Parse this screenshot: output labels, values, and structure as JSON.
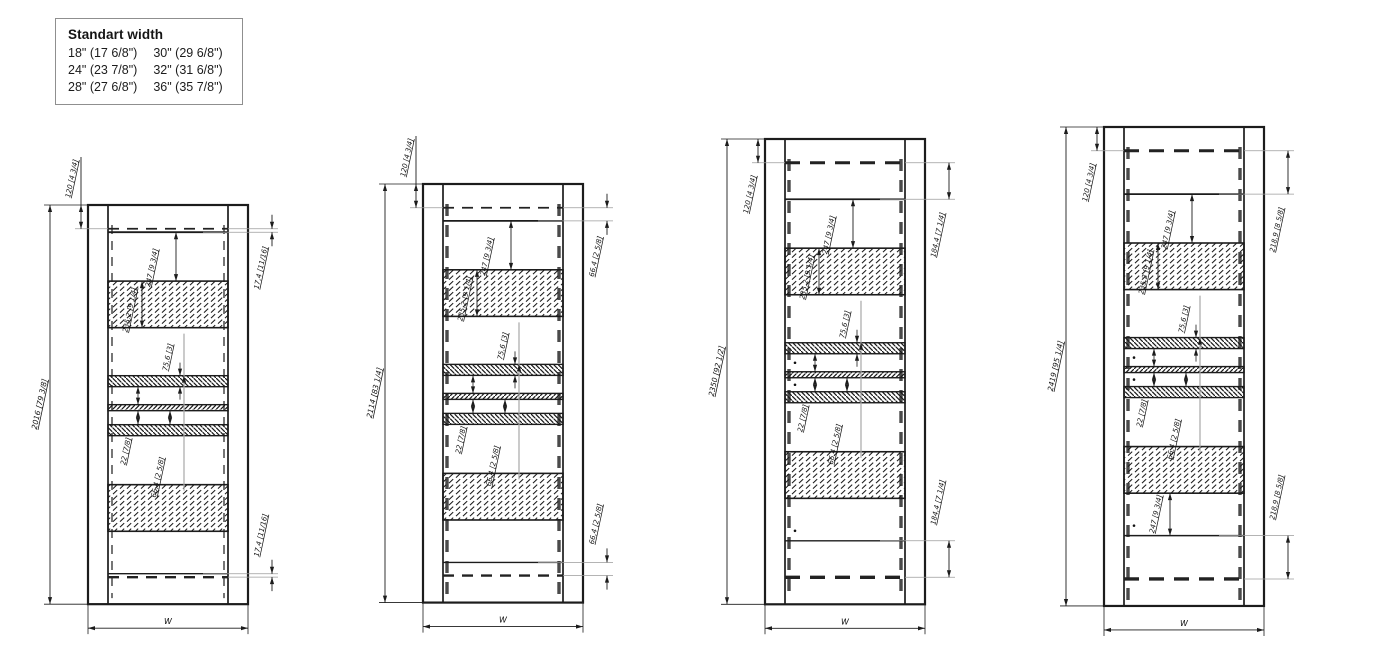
{
  "legend": {
    "title": "Standart width",
    "col1": [
      "18\" (17 6/8\")",
      "24\" (23 7/8\")",
      "28\" (27 6/8\")"
    ],
    "col2": [
      "30\" (29 6/8\")",
      "32\" (31 6/8\")",
      "36\" (35 7/8\")"
    ]
  },
  "colors": {
    "line": "#1c1c1c",
    "thin_line": "#9c9c9c",
    "dash_gray": "#4a4a4a",
    "background": "#ffffff"
  },
  "drawings": [
    {
      "name": "panel-height-2016",
      "overall_height_label": "2016 [79 3/8]",
      "top_inset_label": "120 [4 3/4]",
      "edge_top_label": "17,4 [11/16]",
      "edge_bottom_label": "17,4 [11/16]",
      "block_offset_label": "247 [9 3/4]",
      "block_height_label": "235,2 [9 1/4]",
      "mid_span_label": "75,6 [3]",
      "rail_gap_label": "22 [7/8]",
      "lower_span_label": "66,4 [2 5/8]",
      "bottom_block_offset_label": "",
      "width_label": "W",
      "height_mm": 2016,
      "edge_gap_mm": 17.4,
      "frame_left": 88,
      "frame_top": 205,
      "side_dash_heavy": false,
      "h_dash_heavy": false,
      "top_label_below": false,
      "show_dots": false,
      "show_bottom_block_offset": false
    },
    {
      "name": "panel-height-2114",
      "overall_height_label": "2114 [83 1/4]",
      "top_inset_label": "120 [4 3/4]",
      "edge_top_label": "66,4 [2 5/8]",
      "edge_bottom_label": "66,4 [2 5/8]",
      "block_offset_label": "247 [9 3/4]",
      "block_height_label": "235,2 [9 1/4]",
      "mid_span_label": "75,6 [3]",
      "rail_gap_label": "22 [7/8]",
      "lower_span_label": "66,4 [2 5/8]",
      "bottom_block_offset_label": "",
      "width_label": "W",
      "height_mm": 2114,
      "edge_gap_mm": 66.4,
      "frame_left": 423,
      "frame_top": 184,
      "side_dash_heavy": true,
      "h_dash_heavy": false,
      "top_label_below": false,
      "show_dots": false,
      "show_bottom_block_offset": false
    },
    {
      "name": "panel-height-2350",
      "overall_height_label": "2350 [92 1/2]",
      "top_inset_label": "120 [4 3/4]",
      "edge_top_label": "184,4 [7 1/4]",
      "edge_bottom_label": "184,4 [7 1/4]",
      "block_offset_label": "247 [9 3/4]",
      "block_height_label": "235,2 [9 1/4]",
      "mid_span_label": "75,6 [3]",
      "rail_gap_label": "22 [7/8]",
      "lower_span_label": "66,4 [2 5/8]",
      "bottom_block_offset_label": "",
      "width_label": "W",
      "height_mm": 2350,
      "edge_gap_mm": 184.4,
      "frame_left": 765,
      "frame_top": 139,
      "side_dash_heavy": true,
      "h_dash_heavy": true,
      "top_label_below": true,
      "show_dots": true,
      "show_bottom_block_offset": false
    },
    {
      "name": "panel-height-2419",
      "overall_height_label": "2419 [95 1/4]",
      "top_inset_label": "120 [4 3/4]",
      "edge_top_label": "218,9 [8 5/8]",
      "edge_bottom_label": "218,9 [8 5/8]",
      "block_offset_label": "247 [9 3/4]",
      "block_height_label": "235,2 [9 1/4]",
      "mid_span_label": "75,6 [3]",
      "rail_gap_label": "22 [7/8]",
      "lower_span_label": "66,4 [2 5/8]",
      "bottom_block_offset_label": "247 [9 3/4]",
      "width_label": "W",
      "height_mm": 2419,
      "edge_gap_mm": 218.9,
      "frame_left": 1104,
      "frame_top": 127,
      "side_dash_heavy": true,
      "h_dash_heavy": true,
      "top_label_below": true,
      "show_dots": true,
      "show_bottom_block_offset": true
    }
  ]
}
